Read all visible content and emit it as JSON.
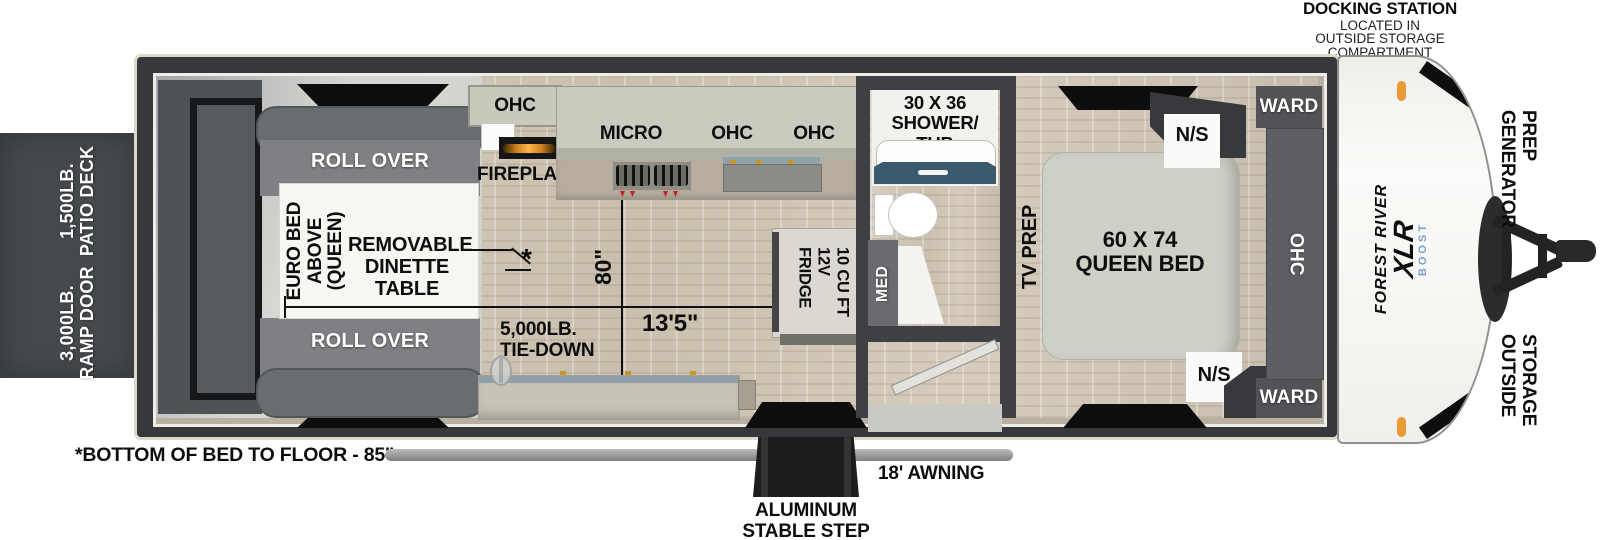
{
  "title": "XLR Boost toy hauler floorplan",
  "annotations": {
    "docking_line1": "DOCKING STATION",
    "docking_line2": "LOCATED IN",
    "docking_line3": "OUTSIDE STORAGE",
    "docking_line4": "COMPARTMENT",
    "patio_deck": "1,500LB.\nPATIO DECK",
    "ramp_door": "3,000LB.\nRAMP DOOR",
    "bottom_note": "*BOTTOM OF BED TO FLOOR - 85\"",
    "awning": "18' AWNING",
    "step": "ALUMINUM\nSTABLE STEP",
    "generator_prep": "GENERATOR\nPREP",
    "outside_storage": "OUTSIDE\nSTORAGE"
  },
  "garage": {
    "roll_over_top": "ROLL OVER",
    "roll_over_bottom": "ROLL OVER",
    "euro_bed": "EURO BED\nABOVE\n(QUEEN)",
    "dinette": "REMOVABLE\nDINETTE\nTABLE",
    "table_marker": "*",
    "tie_down": "5,000LB.\nTIE-DOWN",
    "dim_width": "80\"",
    "dim_length": "13'5\""
  },
  "kitchen": {
    "ohc_left": "OHC",
    "micro": "MICRO",
    "ohc_mid": "OHC",
    "ohc_right": "OHC",
    "fireplace": "FIREPLACE",
    "fridge": "10 CU FT\n12V\nFRIDGE"
  },
  "bathroom": {
    "shower_tub": "30 X 36\nSHOWER/\nTUB",
    "med": "MED"
  },
  "bedroom": {
    "tv_prep": "TV PREP",
    "queen_bed": "60 X 74\nQUEEN BED",
    "ns_top": "N/S",
    "ns_bottom": "N/S",
    "ward_top": "WARD",
    "ward_bottom": "WARD",
    "ohc": "OHC"
  },
  "logo": {
    "brand": "FOREST RIVER",
    "model": "XLR",
    "series": "BOOST"
  },
  "colors": {
    "wall": "#37383b",
    "deck": "#45484c",
    "accent_orange": "#e89a35",
    "boost_blue": "#7b9fd4",
    "tub_blue": "#3c5a6e"
  }
}
